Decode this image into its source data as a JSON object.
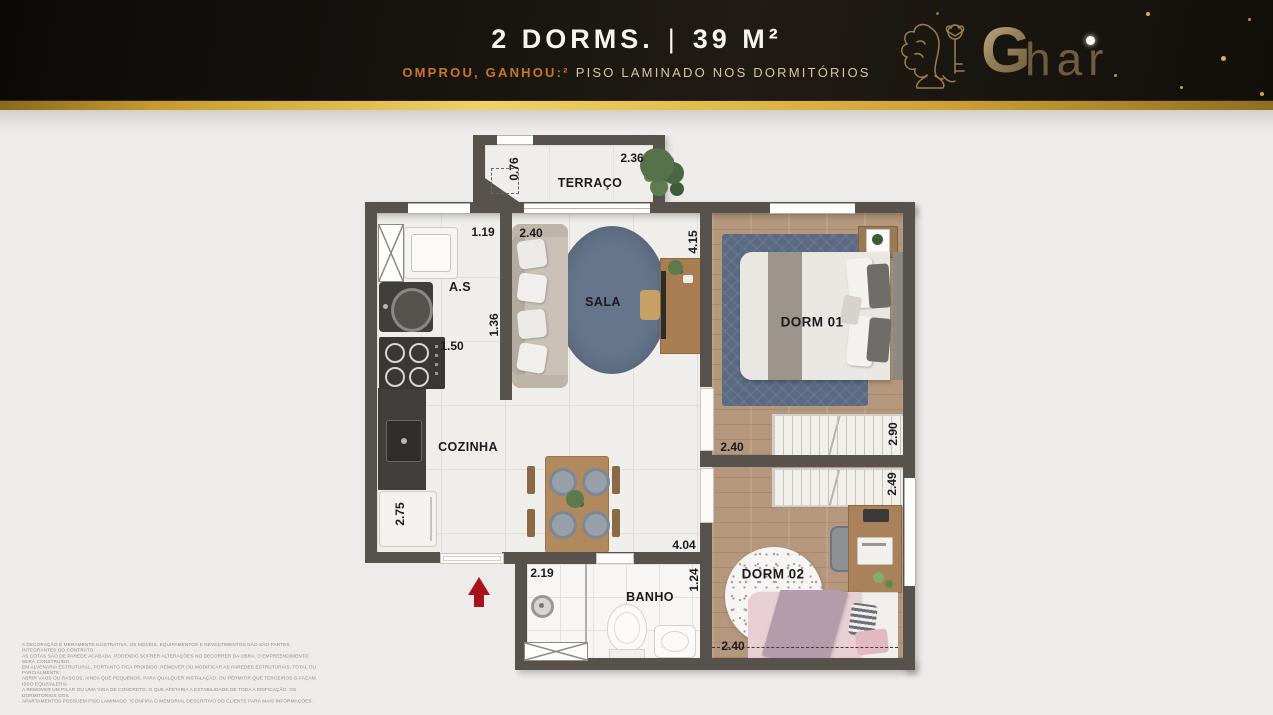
{
  "header": {
    "title_left": "2 DORMS.",
    "title_separator": "|",
    "title_right": "39 M²",
    "subtitle_highlight": "OMPROU, GANHOU:²",
    "subtitle_rest": "PISO LAMINADO NOS DORMITÓRIOS",
    "brand": {
      "initial": "G",
      "rest": "har"
    }
  },
  "floorplan": {
    "rooms": {
      "terraco": "TERRAÇO",
      "as": "A.S",
      "sala": "SALA",
      "cozinha": "COZINHA",
      "banho": "BANHO",
      "dorm1": "DORM 01",
      "dorm2": "DORM 02"
    },
    "dims": {
      "terraco_h": "0.76",
      "terraco_w": "2.36",
      "as_w": "1.19",
      "sala_w": "2.40",
      "sala_h": "4.15",
      "as_h": "1.36",
      "kitchen_w": "1.50",
      "kitchen_h": "2.75",
      "banho_w": "2.19",
      "hall_w": "4.04",
      "banho_h": "1.24",
      "dorm1_w": "2.40",
      "dorm1_h": "2.90",
      "dorm2_h": "2.49",
      "dorm2_w": "2.40"
    }
  },
  "disclaimer": {
    "lines": [
      "A DECORAÇÃO É MERAMENTE ILUSTRATIVA. OS MÓVEIS, EQUIPAMENTOS E REVESTIMENTOS NÃO SÃO PARTES INTEGRANTES DO CONTRATO.",
      "AS COTAS SÃO DE PAREDE ACABADA, PODENDO SOFRER ALTERAÇÕES NO DECORRER DA OBRA. O EMPREENDIMENTO SERÁ CONSTRUÍDO",
      "EM ALVENARIA ESTRUTURAL, PORTANTO FICA PROIBIDO: REMOVER OU MODIFICAR AS PAREDES ESTRUTURAIS, TOTAL OU PARCIALMENTE;",
      "ABRIR VÃOS OU RASGOS, AINDA QUE PEQUENOS, PARA QUALQUER INSTALAÇÃO, OU PERMITIR QUE TERCEIROS O FAÇAM. ISSO EQUIVALERIA",
      "A REMOVER UM PILAR OU UMA VIGA DE CONCRETO, O QUE AFETARIA A ESTABILIDADE DE TODA A EDIFICAÇÃO. OS DORMITÓRIOS DOS",
      "APARTAMENTOS POSSUEM PISO LAMINADO. ²CONFIRA O MEMORIAL DESCRITIVO DO CLIENTE PARA MAIS INFORMAÇÕES."
    ]
  },
  "colors": {
    "header_bg": "#17130e",
    "gold": "#e3bd4a",
    "highlight_orange": "#c8772a",
    "subtitle_tan": "#d8c5a6",
    "wall": "#57534c",
    "rug_blue": "#66758b",
    "wood_floor": "#b4977c",
    "arrow_red": "#a8131b",
    "dorm2_pink": "#e9ced4"
  }
}
